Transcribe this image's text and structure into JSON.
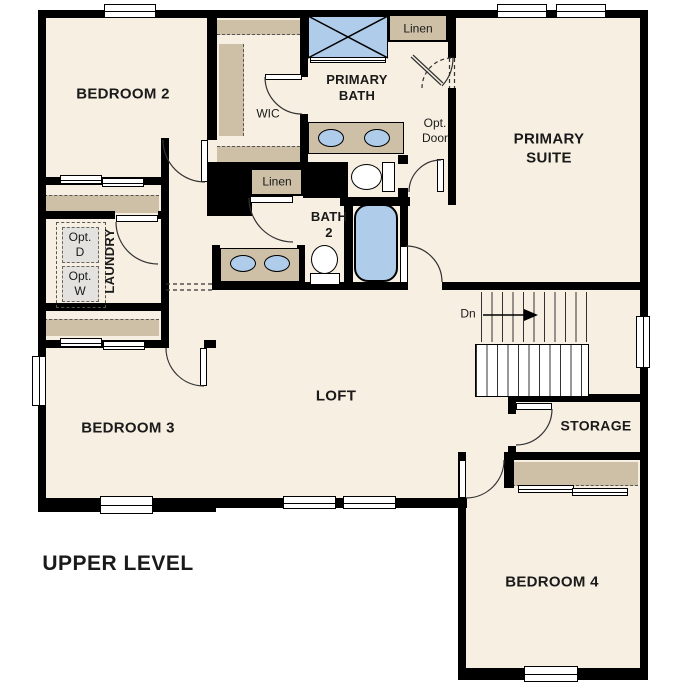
{
  "title": "UPPER LEVEL",
  "rooms": {
    "bedroom2": "BEDROOM 2",
    "wic": "WIC",
    "primary_bath": "PRIMARY\nBATH",
    "primary_suite": "PRIMARY\nSUITE",
    "bath2": "BATH\n2",
    "laundry": "LAUNDRY",
    "loft": "LOFT",
    "bedroom3": "BEDROOM 3",
    "storage": "STORAGE",
    "bedroom4": "BEDROOM 4"
  },
  "closets": {
    "linen_top": "Linen",
    "linen_mid": "Linen"
  },
  "annotations": {
    "opt_door": "Opt.\nDoor",
    "opt_dryer": "Opt.\nD",
    "opt_washer": "Opt.\nW",
    "stairs_down": "Dn"
  },
  "colors": {
    "background": "#ffffff",
    "floor": "#f7efe2",
    "wall": "#000000",
    "shelf": "#cdc0a7",
    "fixture_blue": "#afcdea",
    "opt_box": "#e4e2de"
  }
}
